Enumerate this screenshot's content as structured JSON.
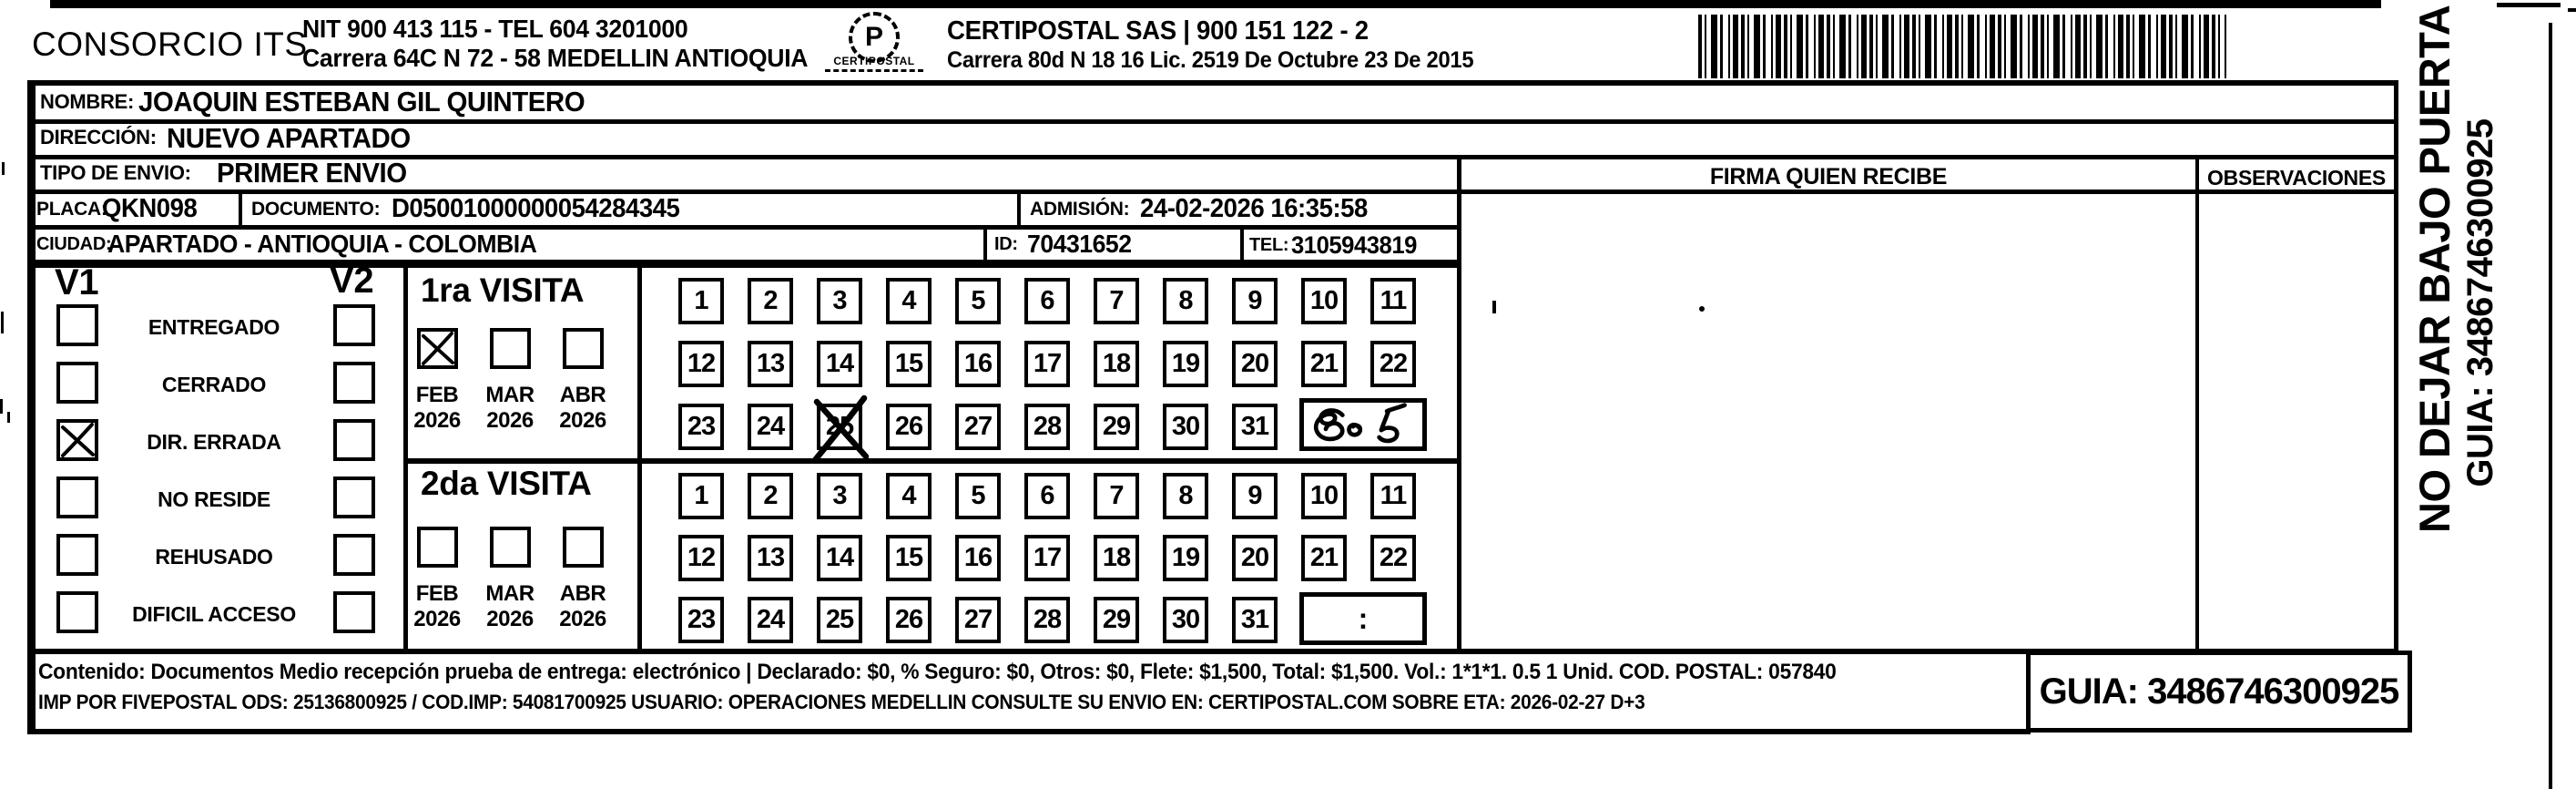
{
  "header": {
    "company": "CONSORCIO ITS",
    "nit_line": "NIT 900 413 115 - TEL 604 3201000",
    "address_line": "Carrera 64C N 72 - 58 MEDELLIN ANTIOQUIA",
    "logo_text": "CERTIPOSTAL",
    "provider_line": "CERTIPOSTAL SAS | 900 151 122 - 2",
    "provider_address": "Carrera 80d N 18 16  Lic. 2519 De Octubre 23 De 2015"
  },
  "form": {
    "nombre_label": "NOMBRE:",
    "nombre": "JOAQUIN ESTEBAN GIL QUINTERO",
    "direccion_label": "DIRECCIÓN:",
    "direccion": "NUEVO APARTADO",
    "tipo_label": "TIPO DE ENVIO:",
    "tipo": "PRIMER ENVIO",
    "placa_label": "PLACA:",
    "placa": "QKN098",
    "documento_label": "DOCUMENTO:",
    "documento": "D05001000000054284345",
    "admision_label": "ADMISIÓN:",
    "admision": "24-02-2026 16:35:58",
    "ciudad_label": "CIUDAD:",
    "ciudad": "APARTADO - ANTIOQUIA - COLOMBIA",
    "id_label": "ID:",
    "id_value": "70431652",
    "tel_label": "TEL:",
    "tel_value": "3105943819"
  },
  "status": {
    "v1_label": "V1",
    "v2_label": "V2",
    "options": [
      "ENTREGADO",
      "CERRADO",
      "DIR. ERRADA",
      "NO RESIDE",
      "REHUSADO",
      "DIFICIL ACCESO"
    ],
    "v1_checked": "DIR. ERRADA"
  },
  "visits": {
    "visit1": {
      "title": "1ra VISITA",
      "months": [
        "FEB",
        "MAR",
        "ABR"
      ],
      "year": "2026",
      "checked_month": "FEB",
      "crossed_day": "25",
      "handwritten_time": "8:05"
    },
    "visit2": {
      "title": "2da VISITA",
      "months": [
        "FEB",
        "MAR",
        "ABR"
      ],
      "year": "2026",
      "time_placeholder": ":"
    },
    "day_rows": [
      [
        "1",
        "2",
        "3",
        "4",
        "5",
        "6",
        "7",
        "8",
        "9",
        "10",
        "11"
      ],
      [
        "12",
        "13",
        "14",
        "15",
        "16",
        "17",
        "18",
        "19",
        "20",
        "21",
        "22"
      ],
      [
        "23",
        "24",
        "25",
        "26",
        "27",
        "28",
        "29",
        "30",
        "31"
      ]
    ]
  },
  "signature": {
    "firma_label": "FIRMA QUIEN RECIBE",
    "observaciones_label": "OBSERVACIONES"
  },
  "side": {
    "warning": "NO DEJAR BAJO PUERTA",
    "guia": "GUIA: 3486746300925"
  },
  "footer": {
    "line1": "Contenido: Documentos Medio recepción prueba de entrega: electrónico | Declarado: $0, % Seguro: $0, Otros: $0, Flete: $1,500, Total: $1,500. Vol.: 1*1*1. 0.5 1 Unid. COD. POSTAL: 057840",
    "line2": "IMP POR FIVEPOSTAL ODS: 25136800925 / COD.IMP: 54081700925 USUARIO: OPERACIONES MEDELLIN CONSULTE SU ENVIO EN: CERTIPOSTAL.COM SOBRE ETA: 2026-02-27 D+3",
    "guia_box": "GUIA: 3486746300925"
  }
}
